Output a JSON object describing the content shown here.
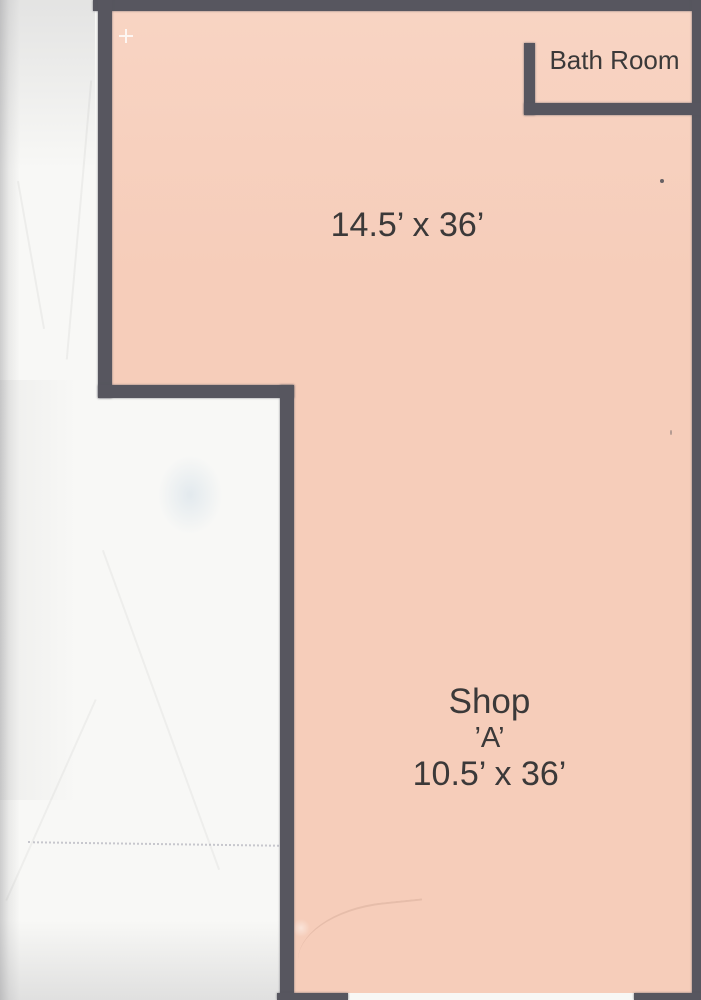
{
  "plan": {
    "bathroom": {
      "label": "Bath Room"
    },
    "upper_area": {
      "dimensions": "14.5’ x 36’"
    },
    "shop": {
      "name": "Shop",
      "unit": "’A’",
      "dimensions": "10.5’ x 36’"
    }
  },
  "colors": {
    "paper": "#f8f8f6",
    "room-fill": "#f6cdba",
    "room-fill-light": "#f8d4c3",
    "wall": "#57565f",
    "ink": "#3b3939"
  }
}
